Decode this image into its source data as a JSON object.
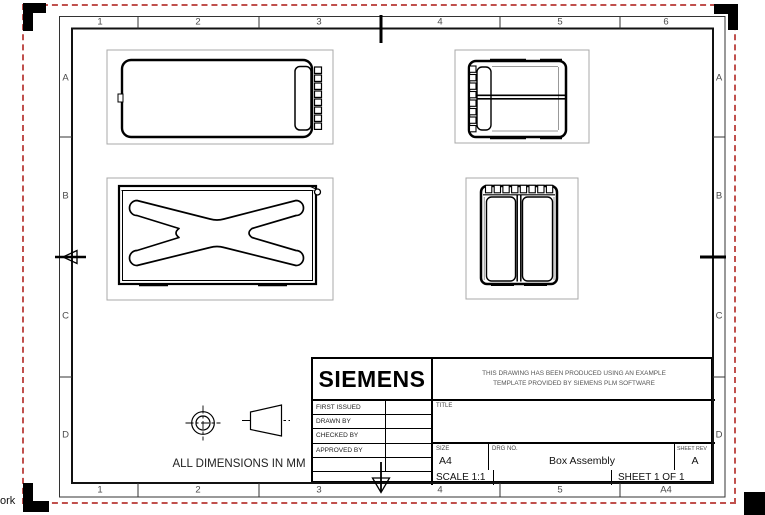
{
  "colors": {
    "line": "#000000",
    "view_border": "#a8a8a8",
    "dash_border": "#c0504d",
    "zone_text": "#4a4a4a"
  },
  "frame": {
    "top_zones": [
      "1",
      "2",
      "3",
      "4",
      "5",
      "6"
    ],
    "bottom_zones": [
      "1",
      "2",
      "3",
      "4",
      "5",
      "A4"
    ],
    "left_zones": [
      "A",
      "B",
      "C",
      "D"
    ],
    "right_zones": [
      "A",
      "B",
      "C",
      "D"
    ]
  },
  "title_block": {
    "logo_text": "SIEMENS",
    "disclaimer_line1": "THIS DRAWING HAS BEEN PRODUCED USING AN EXAMPLE",
    "disclaimer_line2": "TEMPLATE PROVIDED BY SIEMENS PLM SOFTWARE",
    "approval_rows": [
      {
        "label": "FIRST ISSUED",
        "value": ""
      },
      {
        "label": "DRAWN BY",
        "value": ""
      },
      {
        "label": "CHECKED BY",
        "value": ""
      },
      {
        "label": "APPROVED BY",
        "value": ""
      }
    ],
    "title_label": "TITLE",
    "title_value": "",
    "size_label": "SIZE",
    "size_value": "A4",
    "drg_no_label": "DRG NO.",
    "drg_no_value": "Box Assembly",
    "sheet_rev_label": "SHEET REV",
    "sheet_rev_value": "A",
    "scale_text": "SCALE 1:1",
    "sheet_text": "SHEET 1 OF 1"
  },
  "annotations": {
    "dimensions_note": "ALL DIMENSIONS IN MM",
    "clipped_text_bottom_left": "ork"
  }
}
